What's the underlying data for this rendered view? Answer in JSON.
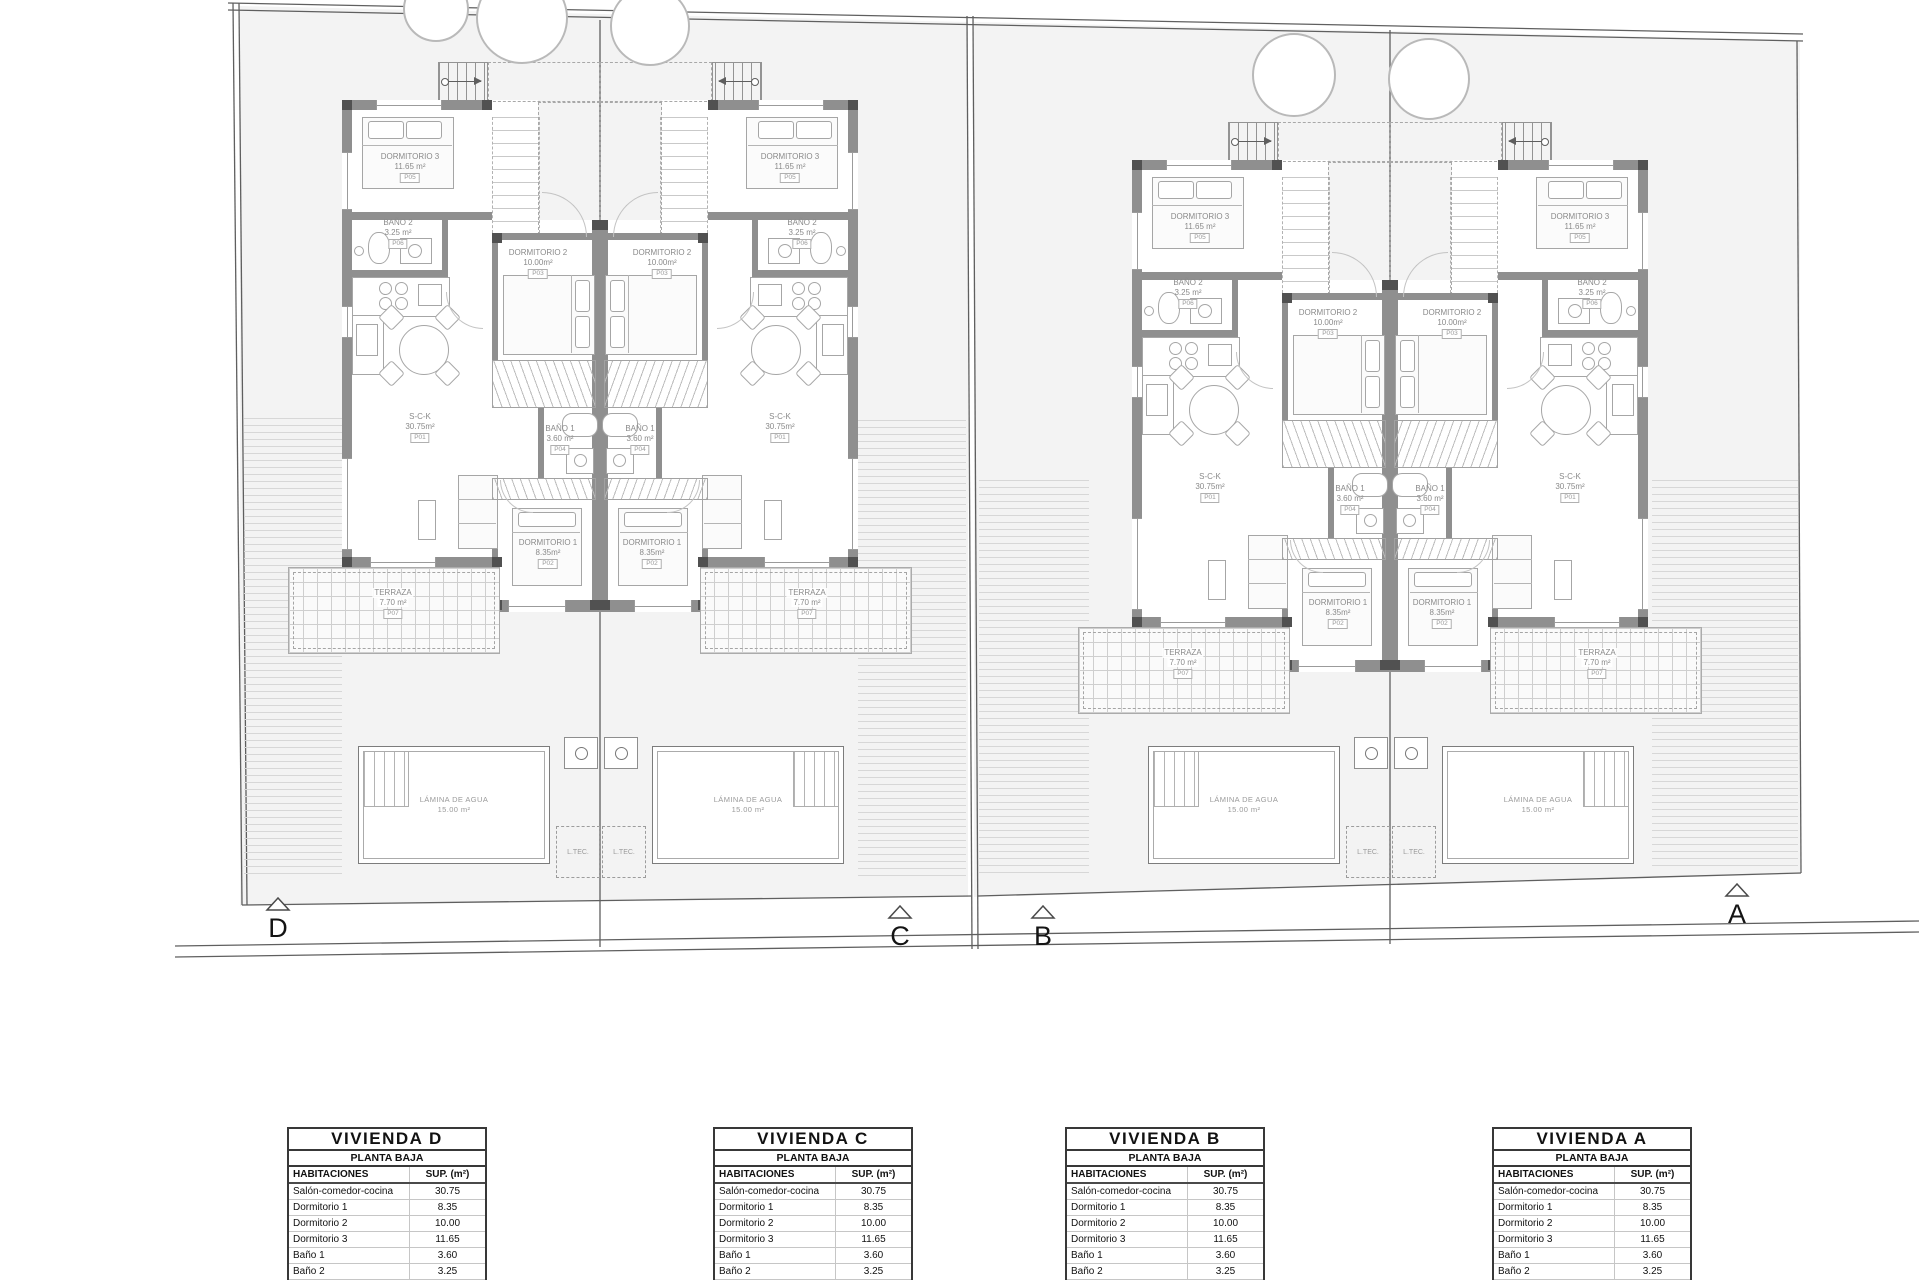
{
  "site": {
    "pool": {
      "name": "LÁMINA DE AGUA",
      "area": "15.00 m²"
    },
    "ltec_label": "L.TEC.",
    "markers": [
      {
        "label": "D"
      },
      {
        "label": "C"
      },
      {
        "label": "B"
      },
      {
        "label": "A"
      }
    ]
  },
  "units": [
    {
      "id": "D",
      "rooms": {
        "sck": {
          "name": "S-C-K",
          "area": "30.75m²",
          "tag": "P01"
        },
        "dorm1": {
          "name": "DORMITORIO 1",
          "area": "8.35m²",
          "tag": "P02"
        },
        "dorm2": {
          "name": "DORMITORIO 2",
          "area": "10.00m²",
          "tag": "P03"
        },
        "bano1": {
          "name": "BAÑO 1",
          "area": "3.60 m²",
          "tag": "P04"
        },
        "dorm3": {
          "name": "DORMITORIO 3",
          "area": "11.65 m²",
          "tag": "P05"
        },
        "bano2": {
          "name": "BAÑO 2",
          "area": "3.25 m²",
          "tag": "P06"
        },
        "terraza": {
          "name": "TERRAZA",
          "area": "7.70 m²",
          "tag": "P07"
        }
      }
    },
    {
      "id": "C",
      "rooms": {
        "sck": {
          "name": "S-C-K",
          "area": "30.75m²",
          "tag": "P01"
        },
        "dorm1": {
          "name": "DORMITORIO 1",
          "area": "8.35m²",
          "tag": "P02"
        },
        "dorm2": {
          "name": "DORMITORIO 2",
          "area": "10.00m²",
          "tag": "P03"
        },
        "bano1": {
          "name": "BAÑO 1",
          "area": "3.60 m²",
          "tag": "P04"
        },
        "dorm3": {
          "name": "DORMITORIO 3",
          "area": "11.65 m²",
          "tag": "P05"
        },
        "bano2": {
          "name": "BAÑO 2",
          "area": "3.25 m²",
          "tag": "P06"
        },
        "terraza": {
          "name": "TERRAZA",
          "area": "7.70 m²",
          "tag": "P07"
        }
      }
    },
    {
      "id": "B",
      "rooms": {
        "sck": {
          "name": "S-C-K",
          "area": "30.75m²",
          "tag": "P01"
        },
        "dorm1": {
          "name": "DORMITORIO 1",
          "area": "8.35m²",
          "tag": "P02"
        },
        "dorm2": {
          "name": "DORMITORIO 2",
          "area": "10.00m²",
          "tag": "P03"
        },
        "bano1": {
          "name": "BAÑO 1",
          "area": "3.60 m²",
          "tag": "P04"
        },
        "dorm3": {
          "name": "DORMITORIO 3",
          "area": "11.65 m²",
          "tag": "P05"
        },
        "bano2": {
          "name": "BAÑO 2",
          "area": "3.25 m²",
          "tag": "P06"
        },
        "terraza": {
          "name": "TERRAZA",
          "area": "7.70 m²",
          "tag": "P07"
        }
      }
    },
    {
      "id": "A",
      "rooms": {
        "sck": {
          "name": "S-C-K",
          "area": "30.75m²",
          "tag": "P01"
        },
        "dorm1": {
          "name": "DORMITORIO 1",
          "area": "8.35m²",
          "tag": "P02"
        },
        "dorm2": {
          "name": "DORMITORIO 2",
          "area": "10.00m²",
          "tag": "P03"
        },
        "bano1": {
          "name": "BAÑO 1",
          "area": "3.60 m²",
          "tag": "P04"
        },
        "dorm3": {
          "name": "DORMITORIO 3",
          "area": "11.65 m²",
          "tag": "P05"
        },
        "bano2": {
          "name": "BAÑO 2",
          "area": "3.25 m²",
          "tag": "P06"
        },
        "terraza": {
          "name": "TERRAZA",
          "area": "7.70 m²",
          "tag": "P07"
        }
      }
    }
  ],
  "tables": [
    {
      "title": "VIVIENDA D",
      "subtitle": "PLANTA BAJA",
      "col1": "HABITACIONES",
      "col2": "SUP. (m²)",
      "rows": [
        [
          "Salón-comedor-cocina",
          "30.75"
        ],
        [
          "Dormitorio 1",
          "8.35"
        ],
        [
          "Dormitorio 2",
          "10.00"
        ],
        [
          "Dormitorio 3",
          "11.65"
        ],
        [
          "Baño 1",
          "3.60"
        ],
        [
          "Baño 2",
          "3.25"
        ],
        [
          "Terraza 1",
          "7,70 (no comp)"
        ]
      ],
      "total_label": "S. Útil (m²)",
      "total_value": "67.60"
    },
    {
      "title": "VIVIENDA C",
      "subtitle": "PLANTA BAJA",
      "col1": "HABITACIONES",
      "col2": "SUP. (m²)",
      "rows": [
        [
          "Salón-comedor-cocina",
          "30.75"
        ],
        [
          "Dormitorio 1",
          "8.35"
        ],
        [
          "Dormitorio 2",
          "10.00"
        ],
        [
          "Dormitorio 3",
          "11.65"
        ],
        [
          "Baño 1",
          "3.60"
        ],
        [
          "Baño 2",
          "3.25"
        ],
        [
          "Terraza 1",
          "7,70 (no comp)"
        ]
      ],
      "total_label": "S. Útil (m²)",
      "total_value": "67.60"
    },
    {
      "title": "VIVIENDA B",
      "subtitle": "PLANTA BAJA",
      "col1": "HABITACIONES",
      "col2": "SUP. (m²)",
      "rows": [
        [
          "Salón-comedor-cocina",
          "30.75"
        ],
        [
          "Dormitorio 1",
          "8.35"
        ],
        [
          "Dormitorio 2",
          "10.00"
        ],
        [
          "Dormitorio 3",
          "11.65"
        ],
        [
          "Baño 1",
          "3.60"
        ],
        [
          "Baño 2",
          "3.25"
        ],
        [
          "Terraza 1",
          "7,70 (no comp)"
        ]
      ],
      "total_label": "S. Útil (m²)",
      "total_value": "67.60"
    },
    {
      "title": "VIVIENDA A",
      "subtitle": "PLANTA BAJA",
      "col1": "HABITACIONES",
      "col2": "SUP. (m²)",
      "rows": [
        [
          "Salón-comedor-cocina",
          "30.75"
        ],
        [
          "Dormitorio 1",
          "8.35"
        ],
        [
          "Dormitorio 2",
          "10.00"
        ],
        [
          "Dormitorio 3",
          "11.65"
        ],
        [
          "Baño 1",
          "3.60"
        ],
        [
          "Baño 2",
          "3.25"
        ],
        [
          "Terraza 1",
          "7,70 (no comp)"
        ]
      ],
      "total_label": "S. Útil (m²)",
      "total_value": "67.60"
    }
  ]
}
